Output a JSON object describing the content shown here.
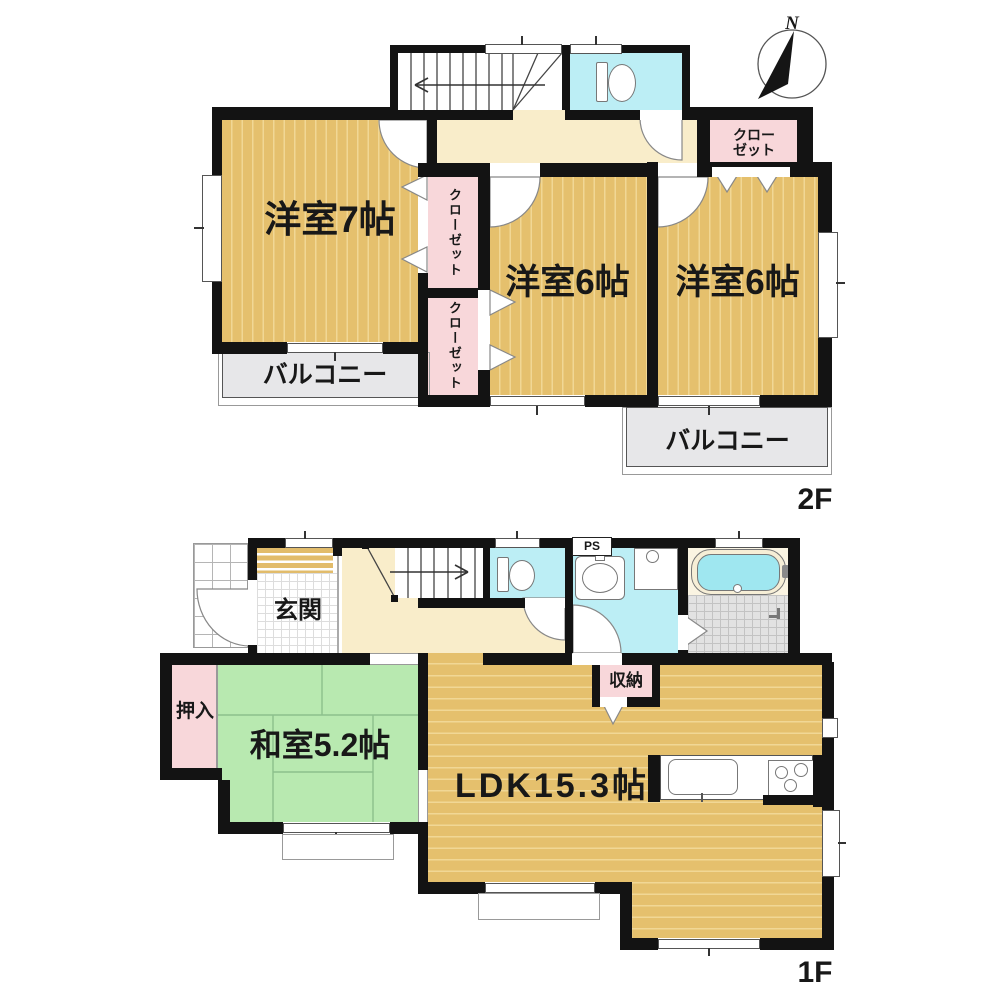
{
  "compass": {
    "north_label": "N"
  },
  "floor2": {
    "floor_label": "2F",
    "room_west": "洋室7帖",
    "room_center": "洋室6帖",
    "room_east": "洋室6帖",
    "closet_upper": "クローゼット",
    "closet_lower": "クローゼット",
    "closet_northeast": "クロー\nゼット",
    "balcony_west": "バルコニー",
    "balcony_south": "バルコニー"
  },
  "floor1": {
    "floor_label": "1F",
    "entrance": "玄関",
    "japanese_room": "和室5.2帖",
    "ldk": "LDK15.3帖",
    "oshiire": "押入",
    "storage": "収納",
    "pipe_space": "PS"
  },
  "colors": {
    "wood_floor": "#e5c06d",
    "tatami_green": "#b8e9b0",
    "closet_pink": "#f8d7da",
    "water_cyan": "#bceef5",
    "hall_cream": "#f9edca",
    "balcony_gray": "#e7e7e9",
    "wall_black": "#131313"
  }
}
